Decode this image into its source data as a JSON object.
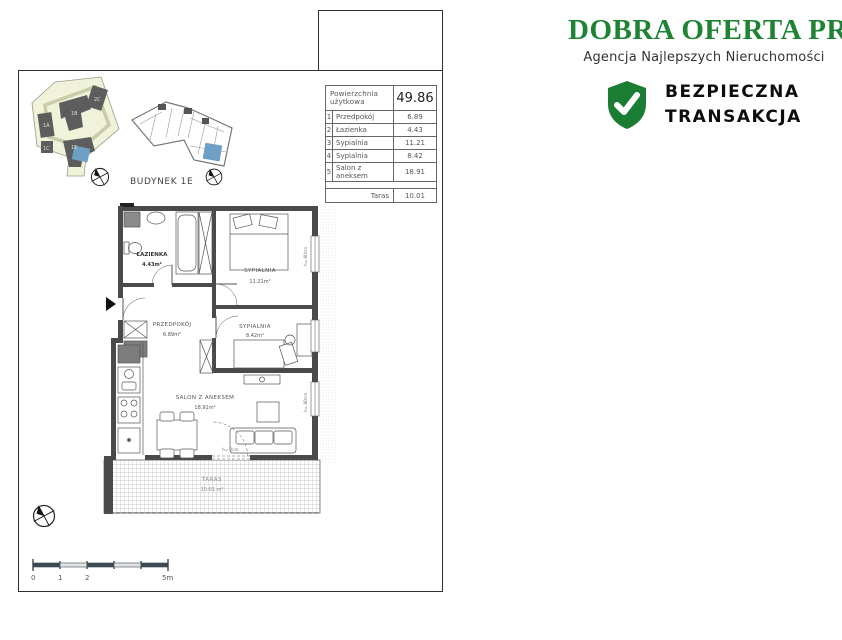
{
  "brand": {
    "name": "DOBRA OFERTA PRO",
    "tagline": "Agencja Najlepszych Nieruchomości",
    "badge": {
      "line1": "BEZPIECZNA",
      "line2": "TRANSAKCJA"
    },
    "green": "#1e8434"
  },
  "site": {
    "building_label": "BUDYNEK 1E",
    "unit_labels": {
      "a": "1A",
      "b": "1B",
      "c": "1C",
      "e": "1E",
      "c2": "2C"
    },
    "unit_blue": "#6f9fc4",
    "site_fill": "#f0f2da"
  },
  "area_table": {
    "header": {
      "label": "Powierzchnia użytkowa",
      "value": "49.86"
    },
    "rows": [
      {
        "no": "1",
        "label": "Przedpokój",
        "value": "6.89"
      },
      {
        "no": "2",
        "label": "Łazienka",
        "value": "4.43"
      },
      {
        "no": "3",
        "label": "Sypialnia",
        "value": "11.21"
      },
      {
        "no": "4",
        "label": "Sypialnia",
        "value": "8.42"
      },
      {
        "no": "5",
        "label": "Salon z aneksem",
        "value": "18.91"
      }
    ],
    "footer": {
      "label": "Taras",
      "value": "10.01"
    }
  },
  "floorplan": {
    "rooms": [
      {
        "name": "ŁAZIENKA",
        "area": "4.43m²"
      },
      {
        "name": "SYPIALNIA",
        "area": "11.21m²"
      },
      {
        "name": "PRZEDPOKÓJ",
        "area": "6.89m²"
      },
      {
        "name": "SYPIALNIA",
        "area": "8.42m²"
      },
      {
        "name": "SALON Z ANEKSEM",
        "area": "18.91m²"
      },
      {
        "name": "TARAS",
        "area": "10.01 m²"
      }
    ],
    "window_height_label": "h= 80cm",
    "door_height_label": "h= 0cm"
  },
  "scale_bar": {
    "labels": [
      "0",
      "1",
      "2",
      "5m"
    ]
  }
}
